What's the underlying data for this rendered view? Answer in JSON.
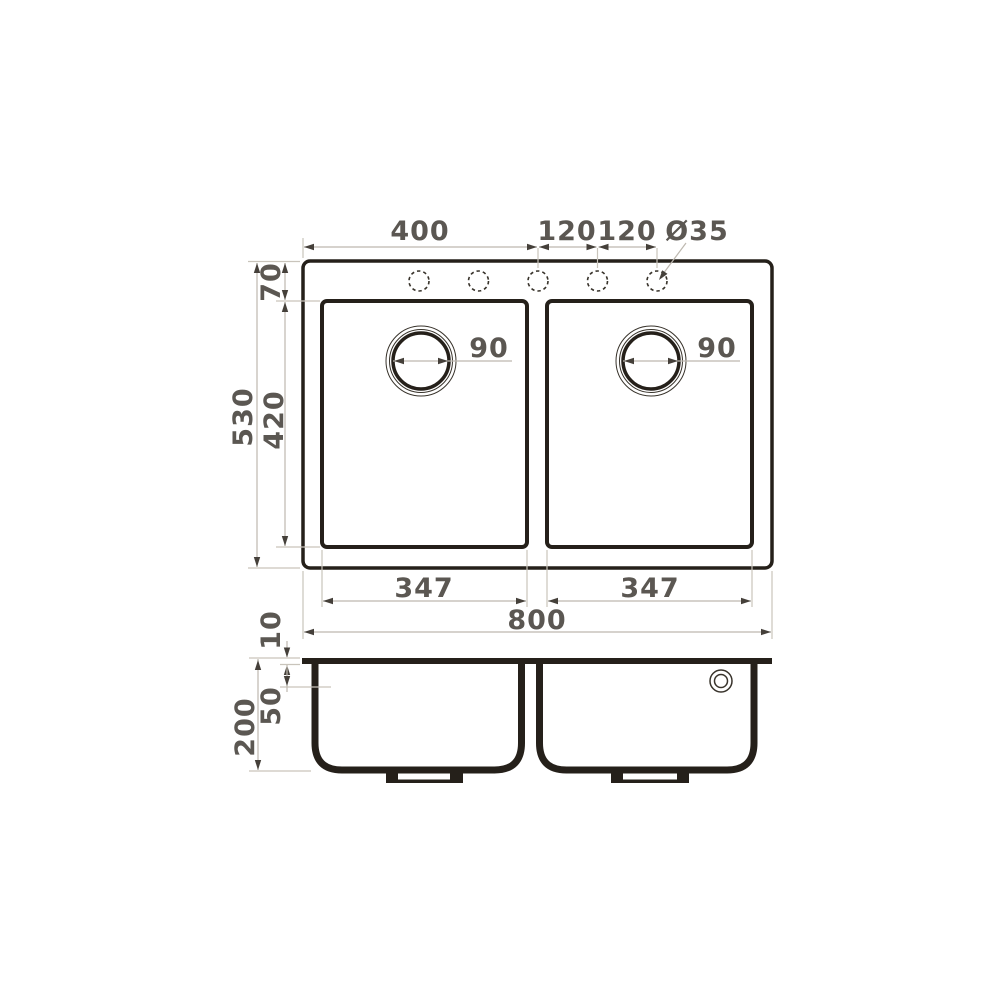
{
  "page": {
    "title": "Double bowl kitchen sink dimensional drawing",
    "background": "#ffffff"
  },
  "colors": {
    "outline": "#25201a",
    "dim_line": "#bdb8af",
    "ext_line": "#c9c4bb",
    "arrow": "#45403a",
    "text": "#5b5752"
  },
  "top_view": {
    "dims": {
      "edge_to_third_hole": "400",
      "hole_spacing_1": "120",
      "hole_spacing_2": "120",
      "faucet_hole_diameter": "Ø35",
      "rim_to_bowl_top": "70",
      "overall_depth": "530",
      "bowl_depth": "420",
      "drain_left_diameter": "90",
      "drain_right_diameter": "90",
      "bowl_left_width": "347",
      "bowl_right_width": "347",
      "overall_width": "800"
    }
  },
  "section_view": {
    "dims": {
      "rim_thickness": "10",
      "upper_ledge_depth": "50",
      "overall_height": "200"
    }
  }
}
